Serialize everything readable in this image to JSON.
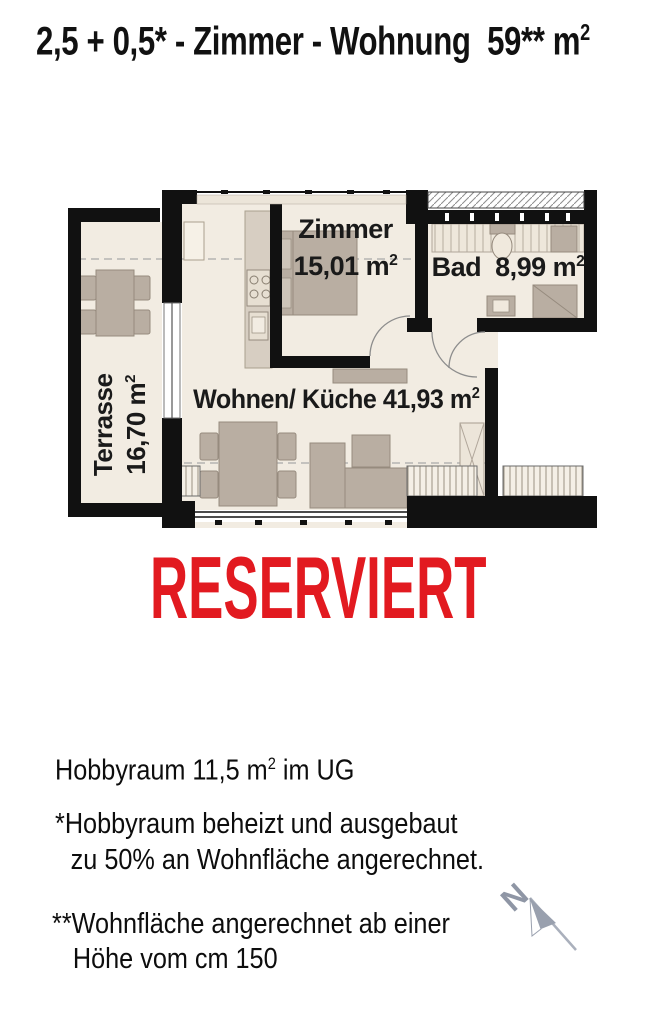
{
  "title": {
    "pre": "2,5 + 0,5* - Zimmer - Wohnung  59** m"
  },
  "units": {
    "sup": "2"
  },
  "status": {
    "label": "RESERVIERT",
    "color": "#e21a20"
  },
  "rooms": {
    "zimmer": {
      "name": "Zimmer",
      "area": "15,01 m"
    },
    "bad": {
      "name": "Bad",
      "area": "8,99 m"
    },
    "wohnen": {
      "name": "Wohnen/ Küche",
      "area": "41,93 m"
    },
    "terrasse": {
      "name": "Terrasse",
      "area": "16,70 m"
    }
  },
  "notes": {
    "hobbyraum_pre": "Hobbyraum 11,5 m",
    "hobbyraum_post": " im UG",
    "note1_line1": "*Hobbyraum beheizt und ausgebaut",
    "note1_line2": "zu 50% an Wohnfläche angerechnet.",
    "note2_line1": "**Wohnfläche angerechnet ab einer",
    "note2_line2": "Höhe vom cm 150"
  },
  "compass": {
    "label": "N"
  },
  "colors": {
    "wall": "#111111",
    "floor": "#f2ece2",
    "furniture": "#b9aea2",
    "status_red": "#e21a20",
    "compass_gray": "#99a0ae"
  }
}
